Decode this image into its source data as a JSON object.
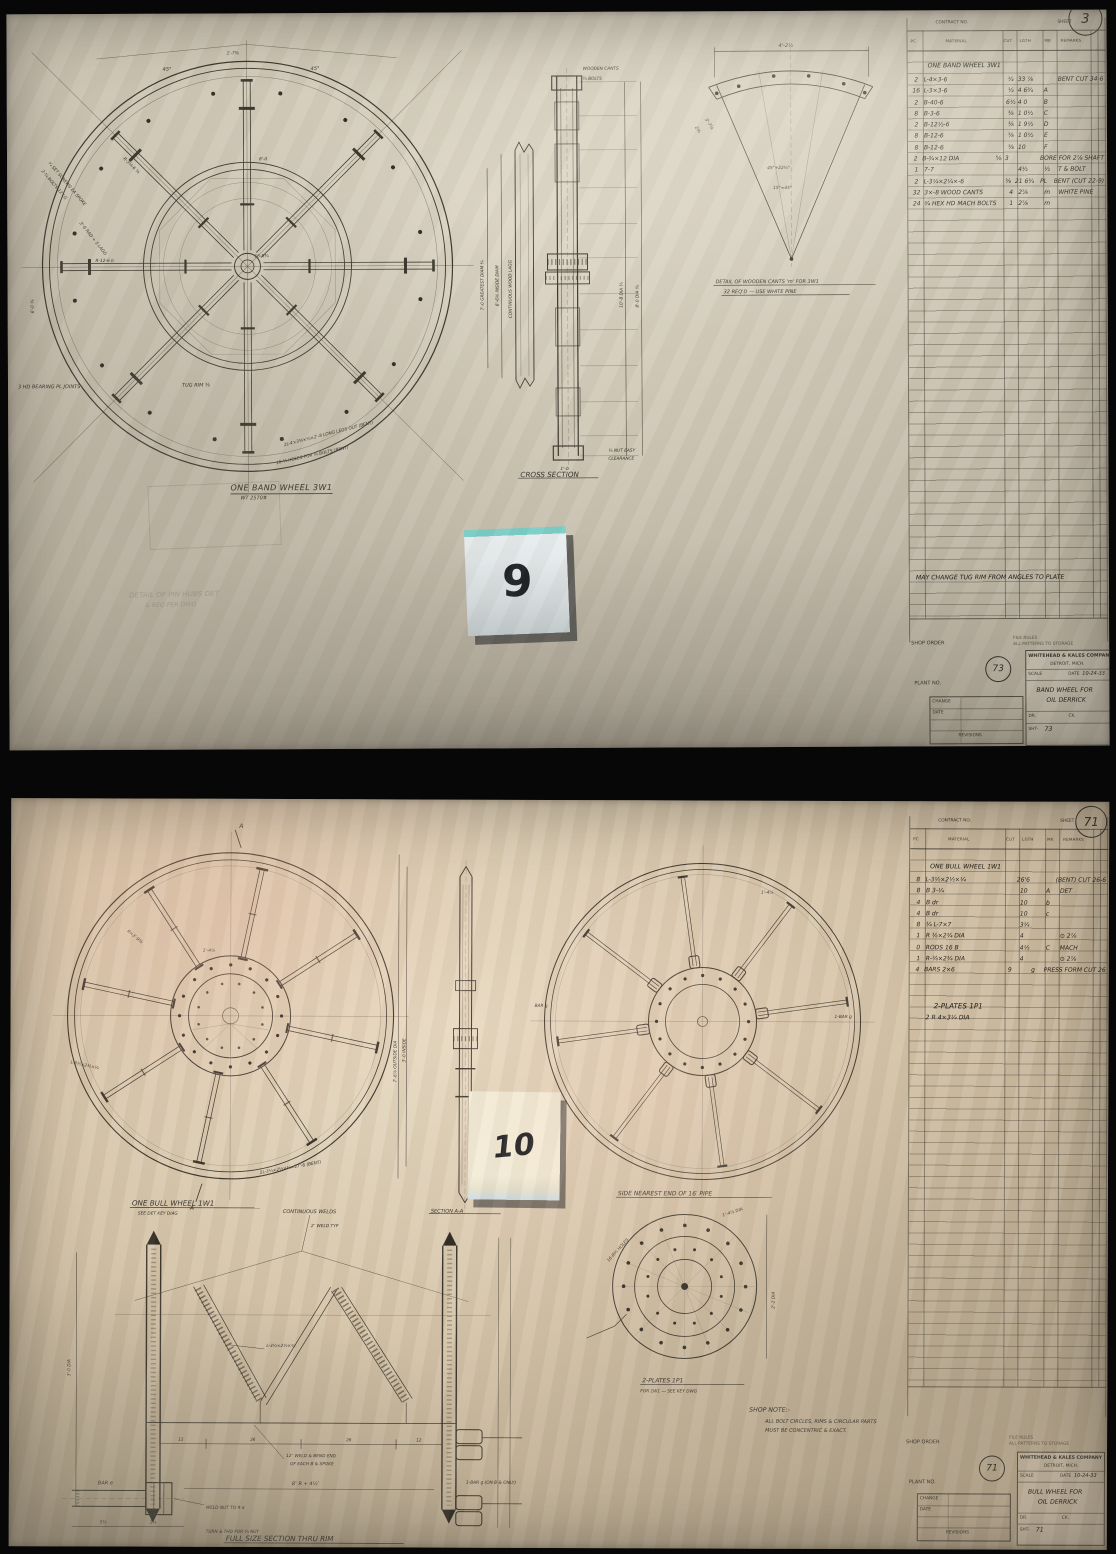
{
  "palette": {
    "paper_top": "#cdc5b4",
    "paper_bottom": "#d5c4a9",
    "ink": "#2e2b25",
    "pencil": "#6e675a",
    "sticky9": "#e9eef0",
    "sticky9_edge": "#7bcfc9",
    "sticky10": "#f3eed9",
    "shadow": "#10141a"
  },
  "sheet9": {
    "header": {
      "contract_label": "CONTRACT NO.",
      "sheet_label": "SHEET",
      "big_num": "3"
    },
    "sticky_label": "9",
    "pencil_note1": "DETAIL OF PIN HUBS DET",
    "pencil_note2": "& REQ PER DWG",
    "bearing_note": "3 HD BEARING PL JOINTS",
    "front": {
      "caption": "ONE BAND WHEEL 3W1",
      "subcaption": "WT 2570#",
      "a45l": "45°",
      "a45r": "45°",
      "atop": "1'-7⅜",
      "ahub": "16-R¾",
      "atug": "TUG RIM ⅜",
      "aspoke": "R-3¼-6 ⅜",
      "awsp": "R-12-6 b",
      "aoct": "8'-0",
      "abolt1": "2-¾ BOLTS 12 LG",
      "abolt2": "¼ SET SCREWS EA SPOKE",
      "alag": "3'-6 RAD + 5 LAGG",
      "aleft": "6'-0 ⅜",
      "abot1": "2L-4×3⅜×¼×2'-8 LONG LEGS OUT (BENT)",
      "abot2": "16-¾ HOLES FOR ¾ BOLTS (BENT)"
    },
    "xsec": {
      "caption": "CROSS SECTION",
      "l1": "7'-0 GREATEST DIAM ¾",
      "l2": "6'-6⅝ INSIDE DIAM",
      "r1": "10'-8 DIA ¾",
      "r2": "8'-0 DIA ¾",
      "t1": "WOODEN CANTS",
      "t2": "¾ BOLTS",
      "lagg": "CONTINUOUS WOOD LAGG",
      "b1": "⅛ NUT EASY",
      "b2": "CLEARANCE",
      "w": "1'-0"
    },
    "cant": {
      "cap1": "DETAIL OF WOODEN CANTS 'm' FOR 3W1",
      "cap2": "32 REQ'D — USE WHITE PINE",
      "d1": "4'-2½",
      "d2": "2⅛",
      "d3": "3'-7⅛",
      "m1": "45°+22½°",
      "m2": "15°=45°"
    },
    "table": {
      "cols": [
        "PC",
        "MATERIAL",
        "CUT",
        "LGTH",
        "MK",
        "REMARKS"
      ],
      "title": "ONE BAND WHEEL 3W1",
      "rows": [
        [
          "2",
          "L-4×3-6",
          "¼",
          "33 ⅞",
          "",
          "BENT CUT 34-6"
        ],
        [
          "16",
          "L-3×3-6",
          "¼",
          "4 6¾",
          "A",
          ""
        ],
        [
          "2",
          "B-40-6",
          "6½",
          "4 0",
          "B",
          ""
        ],
        [
          "8",
          "B-3-6",
          "⅜",
          "1 0½",
          "C",
          ""
        ],
        [
          "2",
          "B-12½-6",
          "⅜",
          "1 9½",
          "D",
          ""
        ],
        [
          "8",
          "B-12-6",
          "⅜",
          "1 0½",
          "E",
          ""
        ],
        [
          "8",
          "B-12-6",
          "⅜",
          "10",
          "F",
          ""
        ],
        [
          "2",
          "B-¾×12 DIA",
          "⅝",
          "3",
          "",
          "BORE FOR 2⅞ SHAFT"
        ],
        [
          "1",
          "7-7",
          "",
          "4½",
          "½",
          "T & BOLT"
        ],
        [
          "2",
          "L-3¼×2¼×-6",
          "⅜",
          "21 6¾",
          "PL",
          "BENT (CUT 22-9)"
        ],
        [
          "32",
          "3×-8 WOOD CANTS",
          "4",
          "2⅞",
          "m",
          "WHITE PINE"
        ],
        [
          "24",
          "¾ HEX HD MACH BOLTS",
          "1",
          "2⅞",
          "m",
          ""
        ]
      ],
      "note": "MAY CHANGE TUG RIM FROM ANGLES TO PLATE"
    },
    "title_block": {
      "shop_order_label": "SHOP ORDER",
      "plant_label": "PLANT NO.",
      "fine1": "FILE RULES",
      "fine2": "ALL PATTERNS TO STORAGE",
      "circ": "73",
      "company": "WHITEHEAD & KALES COMPANY",
      "city": "DETROIT, MICH.",
      "scale_label": "SCALE",
      "date_label": "DATE",
      "date": "10-24-33",
      "job1": "BAND WHEEL FOR",
      "job2": "OIL DERRICK",
      "dr_label": "DR.",
      "ck_label": "CK.",
      "sht_label": "SHT-",
      "sheet_no": "73",
      "rev_label": "REVISIONS",
      "chg_label": "CHANGE",
      "date2_label": "DATE"
    }
  },
  "sheet10": {
    "header": {
      "contract_label": "CONTRACT NO.",
      "sheet_label": "SHEET",
      "big_num": "71"
    },
    "sticky_label": "10",
    "bull": {
      "caption": "ONE BULL WHEEL 1W1",
      "subcaption": "SEE DET KEY DIAG",
      "amark_top": "A",
      "amark_bot": "A",
      "art1": "7'-6⅞ OUTSIDE DIA",
      "art2": "3'-0 INSIDE",
      "aspoke": "R=3'-9⅜",
      "ahub": "1'-4⅞",
      "abent": "2L-3½×2½×¼×27'-6 (BENT)",
      "aangle": "L-3½×2½×¼"
    },
    "secaa": {
      "caption": "SECTION A-A"
    },
    "side": {
      "caption": "SIDE NEAREST END OF 16′ PIPE",
      "abarg_r": "1-BAR g",
      "abarg_l": "BAR g",
      "adim": "1'-4⅞"
    },
    "fullsec": {
      "cap": "FULL SIZE SECTION THRU RIM",
      "cw": "CONTINUOUS WELDS",
      "weld2": "2″ WELD TYP",
      "angle": "L-3½×2½×¼",
      "we1": "12″ WELD & BEND END",
      "we2": "OF EACH B & SPOKE",
      "nut": "WELD NUT TO R a",
      "thd": "TURN & THD FOR ¾ NUT",
      "bare": "BAR e",
      "barg": "1-BAR g (ON B & ONLY)",
      "dim8": "8″ R + 4½″",
      "d12a": "12",
      "d26a": "26",
      "d26b": "26",
      "d12b": "12",
      "d55": "5½",
      "d15": "1⅝",
      "d30": "3'-0 DIA"
    },
    "plate": {
      "cap1": "2-PLATES 1P1",
      "cap2": "FOR 1W1 — SEE KEY DWG",
      "pd1": "1'-4⅞ DIA",
      "pd2": "2'-2 DIA",
      "pd3": "16-R¾ HOLES"
    },
    "shop_note": {
      "t": "SHOP NOTE:-",
      "l1": "ALL BOLT CIRCLES, RIMS & CIRCULAR PARTS",
      "l2": "MUST BE CONCENTRIC & EXACT."
    },
    "table": {
      "cols": [
        "PC",
        "MATERIAL",
        "CUT",
        "LGTH",
        "MK",
        "REMARKS"
      ],
      "title": "ONE BULL WHEEL 1W1",
      "rows": [
        [
          "8",
          "L-3½×2½×¼",
          "",
          "26'6",
          "",
          "(BENT) CUT 26-6"
        ],
        [
          "8",
          "B 3-¼",
          "",
          "10",
          "A",
          "DET"
        ],
        [
          "4",
          "B dr",
          "",
          "10",
          "b",
          ""
        ],
        [
          "4",
          "B dr",
          "",
          "10",
          "c",
          ""
        ],
        [
          "8",
          "¾ L-7×7",
          "",
          "3¼",
          "",
          ""
        ],
        [
          "1",
          "R ⅜×2¾ DIA",
          "",
          "4",
          "",
          "⊙ 2⅞"
        ],
        [
          "0",
          "RODS 16 B",
          "",
          "4½",
          "C",
          "MACH"
        ],
        [
          "1",
          "R-⅜×2¾ DIA",
          "",
          "4",
          "",
          "⊙ 2⅞"
        ],
        [
          "4",
          "BARS 2×6",
          "",
          "9",
          "g",
          "PRESS FORM CUT 26"
        ]
      ],
      "note1": "2-PLATES 1P1",
      "note2": "2 R 4×3¼ DIA"
    },
    "title_block": {
      "shop_order_label": "SHOP ORDER",
      "plant_label": "PLANT NO.",
      "fine1": "FILE RULES",
      "fine2": "ALL PATTERNS TO STORAGE",
      "circ": "71",
      "company": "WHITEHEAD & KALES COMPANY",
      "city": "DETROIT, MICH.",
      "scale_label": "SCALE",
      "date_label": "DATE",
      "date": "10-24-33",
      "job1": "BULL WHEEL FOR",
      "job2": "OIL DERRICK",
      "dr_label": "DR.",
      "ck_label": "CK.",
      "sht_label": "SHT-",
      "sheet_no": "71",
      "rev_label": "REVISIONS",
      "chg_label": "CHANGE",
      "date2_label": "DATE"
    }
  }
}
